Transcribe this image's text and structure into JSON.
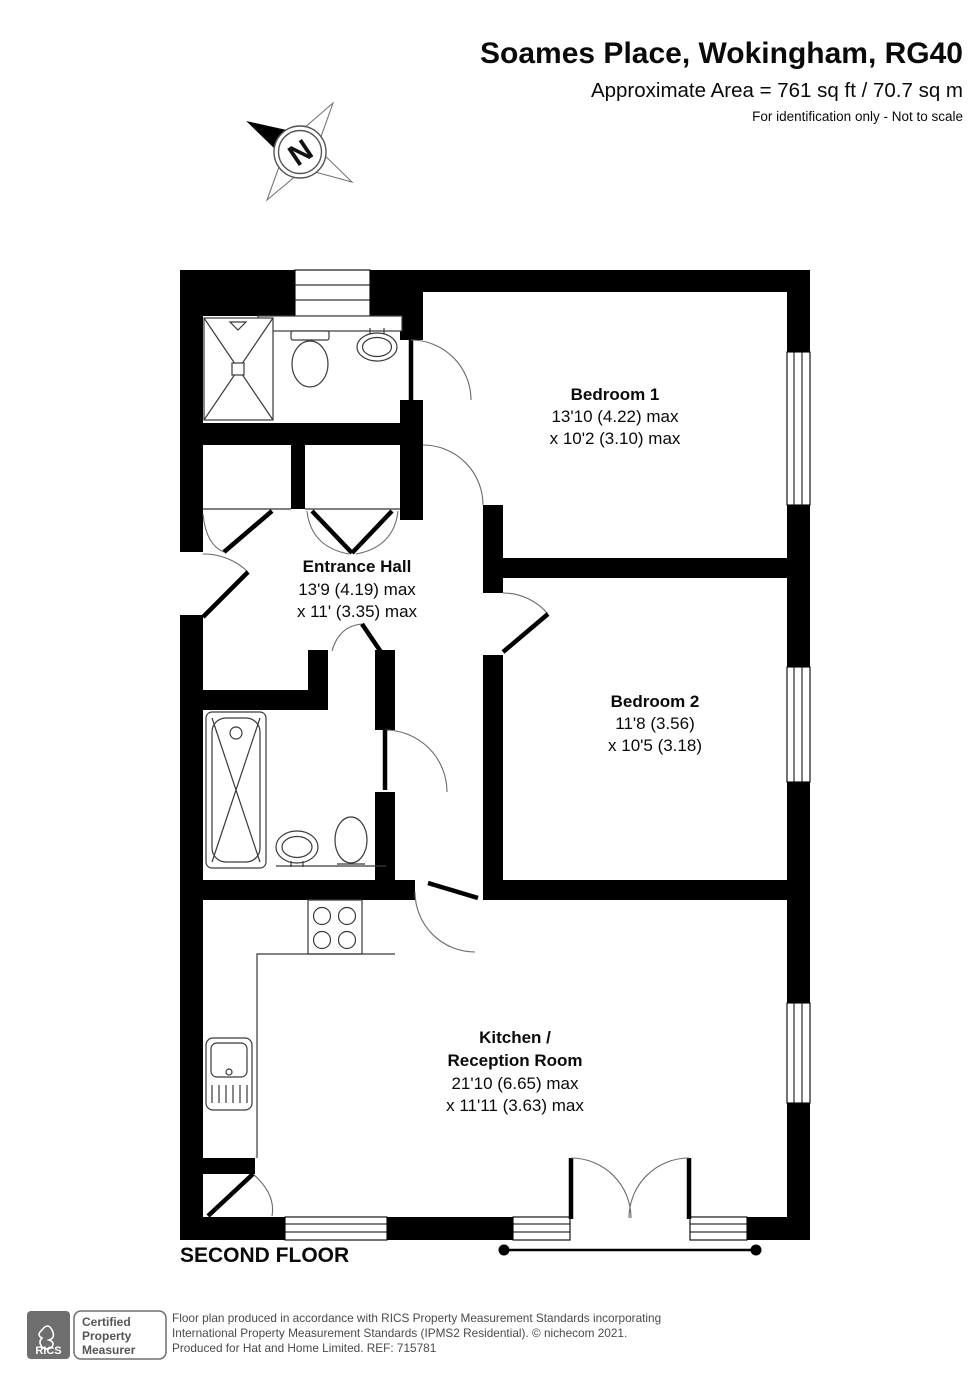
{
  "header": {
    "title": "Soames Place, Wokingham, RG40",
    "area_line": "Approximate Area = 761 sq ft / 70.7 sq m",
    "disclaimer": "For identification only - Not to scale"
  },
  "compass": {
    "north_label": "N"
  },
  "plan": {
    "rooms": [
      {
        "id": "bedroom-1",
        "name": "Bedroom 1",
        "dim_line1": "13'10 (4.22) max",
        "dim_line2": "x 10'2 (3.10) max"
      },
      {
        "id": "entrance-hall",
        "name": "Entrance Hall",
        "dim_line1": "13'9 (4.19) max",
        "dim_line2": "x 11' (3.35) max"
      },
      {
        "id": "bedroom-2",
        "name": "Bedroom 2",
        "dim_line1": "11'8 (3.56)",
        "dim_line2": "x 10'5 (3.18)"
      },
      {
        "id": "kitchen-reception",
        "name_line1": "Kitchen /",
        "name_line2": "Reception Room",
        "dim_line1": "21'10 (6.65) max",
        "dim_line2": "x 11'11 (3.63) max"
      }
    ],
    "floor_label": "SECOND FLOOR"
  },
  "footer": {
    "rics_label": "RICS",
    "badge_lines": [
      "Certified",
      "Property",
      "Measurer"
    ],
    "lines": [
      "Floor plan produced in accordance with RICS Property Measurement Standards incorporating",
      "International Property Measurement Standards (IPMS2 Residential).   © nichecom 2021.",
      "Produced for Hat and Home Limited.    REF:  715781"
    ]
  },
  "colors": {
    "wall": "#000000",
    "footer_gray": "#6e6e6e",
    "background": "#ffffff"
  }
}
